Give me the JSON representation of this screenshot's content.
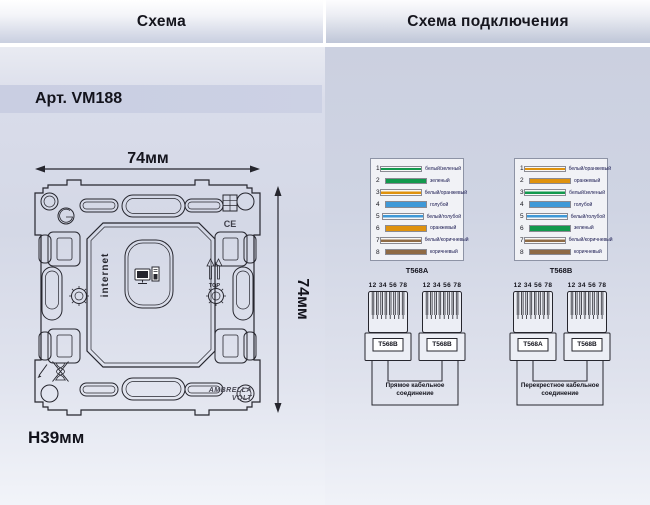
{
  "window": {
    "title_left": "Схема",
    "title_right": "Схема подключения"
  },
  "left_panel": {
    "article": "Арт. VM188",
    "width_label": "74мм",
    "height_label": "74мм",
    "depth_label": "H39мм",
    "socket_label": "internet",
    "top_label": "TOP",
    "ce_label": "CE",
    "brand_line1": "AMBRELLA",
    "brand_line2": "VOLT"
  },
  "right_panel": {
    "wire_tables": [
      {
        "name": "T568A",
        "rows": [
          {
            "num": "1",
            "label": "белый/зеленый",
            "color": "#12994d",
            "striped": true
          },
          {
            "num": "2",
            "label": "зеленый",
            "color": "#12994d",
            "striped": false
          },
          {
            "num": "3",
            "label": "белый/оранжевый",
            "color": "#df920d",
            "striped": true
          },
          {
            "num": "4",
            "label": "голубой",
            "color": "#3f99d8",
            "striped": false
          },
          {
            "num": "5",
            "label": "белый/голубой",
            "color": "#3f99d8",
            "striped": true
          },
          {
            "num": "6",
            "label": "оранжевый",
            "color": "#df920d",
            "striped": false
          },
          {
            "num": "7",
            "label": "белый/коричневый",
            "color": "#8f6b45",
            "striped": true
          },
          {
            "num": "8",
            "label": "коричневый",
            "color": "#8f6b45",
            "striped": false
          }
        ]
      },
      {
        "name": "T568B",
        "rows": [
          {
            "num": "1",
            "label": "белый/оранжевый",
            "color": "#df920d",
            "striped": true
          },
          {
            "num": "2",
            "label": "оранжевый",
            "color": "#df920d",
            "striped": false
          },
          {
            "num": "3",
            "label": "белый/зеленый",
            "color": "#12994d",
            "striped": true
          },
          {
            "num": "4",
            "label": "голубой",
            "color": "#3f99d8",
            "striped": false
          },
          {
            "num": "5",
            "label": "белый/голубой",
            "color": "#3f99d8",
            "striped": true
          },
          {
            "num": "6",
            "label": "зеленый",
            "color": "#12994d",
            "striped": false
          },
          {
            "num": "7",
            "label": "белый/коричневый",
            "color": "#8f6b45",
            "striped": true
          },
          {
            "num": "8",
            "label": "коричневый",
            "color": "#8f6b45",
            "striped": false
          }
        ]
      }
    ],
    "connector_groups": [
      {
        "pin_numbers": "12 34 56 78",
        "connectors": [
          "T568B",
          "T568B"
        ],
        "caption_line1": "Прямое кабельное",
        "caption_line2": "соединение"
      },
      {
        "pin_numbers": "12 34 56 78",
        "connectors": [
          "T568A",
          "T568B"
        ],
        "caption_line1": "Перекрестное кабельное",
        "caption_line2": "соединение"
      }
    ]
  }
}
